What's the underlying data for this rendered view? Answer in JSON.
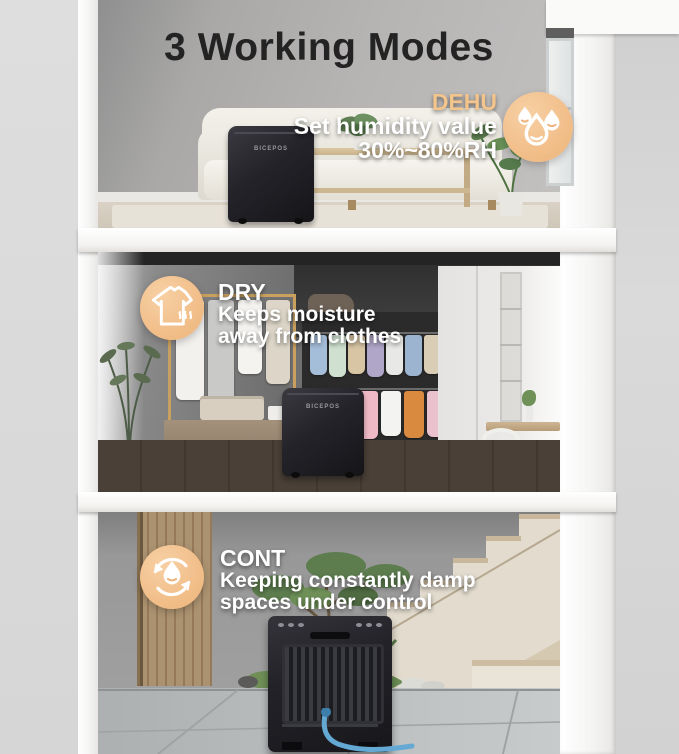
{
  "page": {
    "title": "3 Working Modes"
  },
  "brand": {
    "device_label": "BICEPOS"
  },
  "colors": {
    "accent_circle": "#f2c08c",
    "dehu_label": "#f3c48c",
    "body_text": "#ffffff",
    "title_text": "#232323"
  },
  "modes": [
    {
      "id": "dehu",
      "label": "DEHU",
      "icon": "water-drops-icon",
      "lines": [
        "Set humidity value",
        "30%~80%RH"
      ]
    },
    {
      "id": "dry",
      "label": "DRY",
      "icon": "shirt-steam-icon",
      "lines": [
        "Keeps moisture",
        "away from clothes"
      ]
    },
    {
      "id": "cont",
      "label": "CONT",
      "icon": "cycle-drop-icon",
      "lines": [
        "Keeping constantly damp",
        "spaces under control"
      ]
    }
  ]
}
